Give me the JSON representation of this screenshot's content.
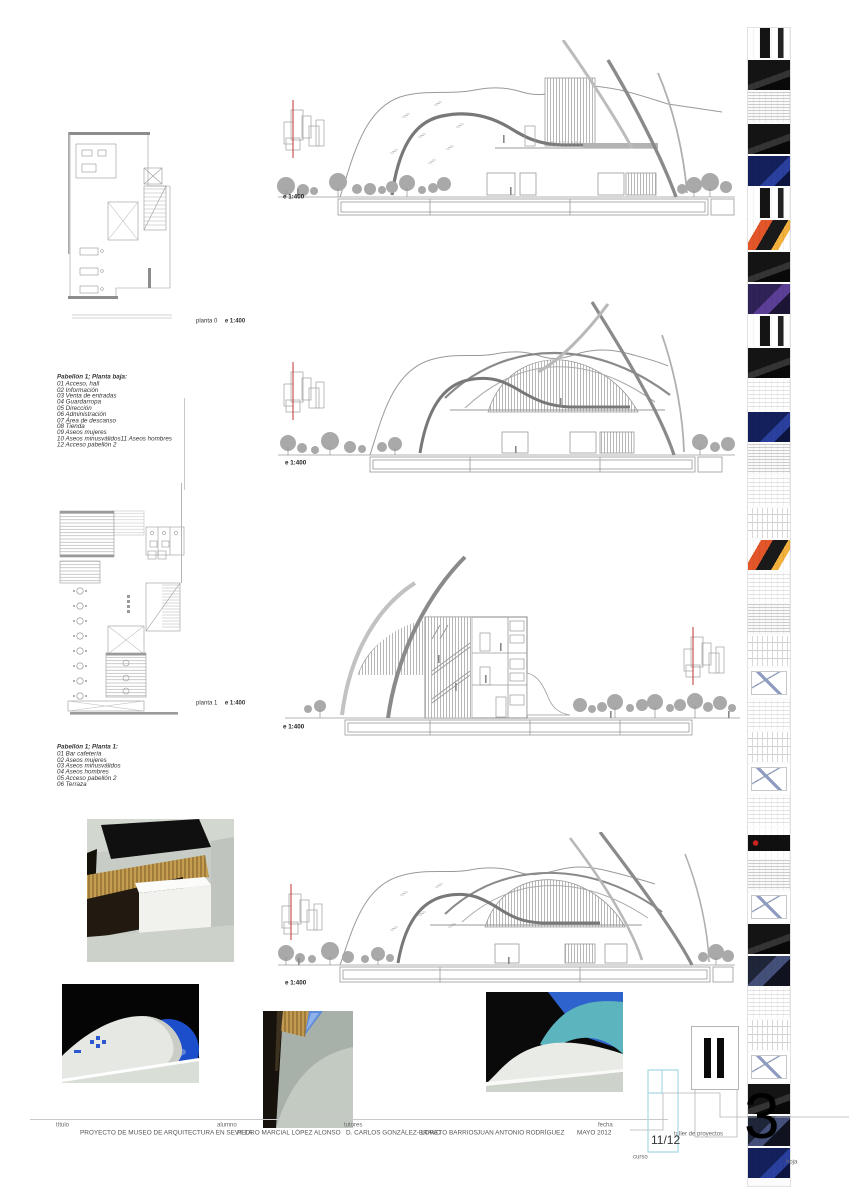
{
  "colors": {
    "line_gray": "#9a9a9a",
    "dark_line": "#7a7a7a",
    "tree_gray": "#a9a9a9",
    "annotation_red": "#c23030",
    "curso_cyan": "#a8d8e6",
    "sky_blue": "#2e63cd",
    "teal": "#5cb4be",
    "wood": "#c59d50",
    "render_sage": "#c7cdc6"
  },
  "plans": {
    "plan0": {
      "caption_label": "planta 0",
      "caption_scale": "e  1:400"
    },
    "plan1": {
      "caption_label": "planta 1",
      "caption_scale": "e  1:400"
    }
  },
  "legends": {
    "planta_baja": {
      "title": "Pabellón 1; Planta baja:",
      "items": [
        "01 Acceso, hall",
        "02 Información",
        "03 Venta de entradas",
        "04 Guardarropa",
        "05 Dirección",
        "06 Administración",
        "07 Área de descanso",
        "08 Tienda",
        "09 Aseos mujeres",
        "10 Aseos minusválidos11 Aseos hombres",
        "12 Acceso pabellón 2"
      ]
    },
    "planta_1": {
      "title": "Pabellón 1; Planta 1:",
      "items": [
        "01 Bar cafetería",
        "02 Aseos mujeres",
        "03 Aseos minusválidos",
        "04 Aseos hombres",
        "05 Acceso pabellón 2",
        "06 Terraza"
      ]
    }
  },
  "drawings": {
    "elevation_1": {
      "scale": "e  1:400"
    },
    "elevation_2": {
      "scale": "e  1:400"
    },
    "section_1": {
      "scale": "e  1:400"
    },
    "elevation_3": {
      "scale": "e  1:400"
    }
  },
  "titleblock": {
    "titulo_label": "título",
    "titulo_value": "PROYECTO DE MUSEO DE ARQUITECTURA EN SEVILLA",
    "alumno_label": "alumno",
    "alumno_value": "PEDRO MARCIAL LÓPEZ ALONSO",
    "tutores_label": "tutores",
    "tutores_value_1": "D. CARLOS GONZÁLEZ-BRAVO",
    "tutores_value_2": "LORETO BARRIOS",
    "tutores_value_3": "JUAN ANTONIO RODRÍGUEZ",
    "fecha_label": "fecha",
    "fecha_value": "MAYO 2012",
    "curso_label": "curso",
    "curso_value": "11/12",
    "taller_label": "taller de proyectos",
    "hoja_label": "hoja",
    "hoja_value": "3"
  },
  "filmstrip": {
    "tiles": [
      "mixed",
      "dark",
      "sheet-dense",
      "dark",
      "blue",
      "mixed",
      "warm",
      "dark",
      "purple",
      "mixed",
      "dark",
      "sheet",
      "blue",
      "sheet-dense",
      "sheet",
      "plan",
      "warm",
      "sheet",
      "sheet-dense",
      "plan",
      "sketch",
      "sheet",
      "plan",
      "sketch",
      "sheet",
      "band",
      "sheet-dense",
      "sketch",
      "dark",
      "photo",
      "sheet",
      "plan",
      "sketch",
      "dark",
      "photo",
      "blue"
    ]
  }
}
